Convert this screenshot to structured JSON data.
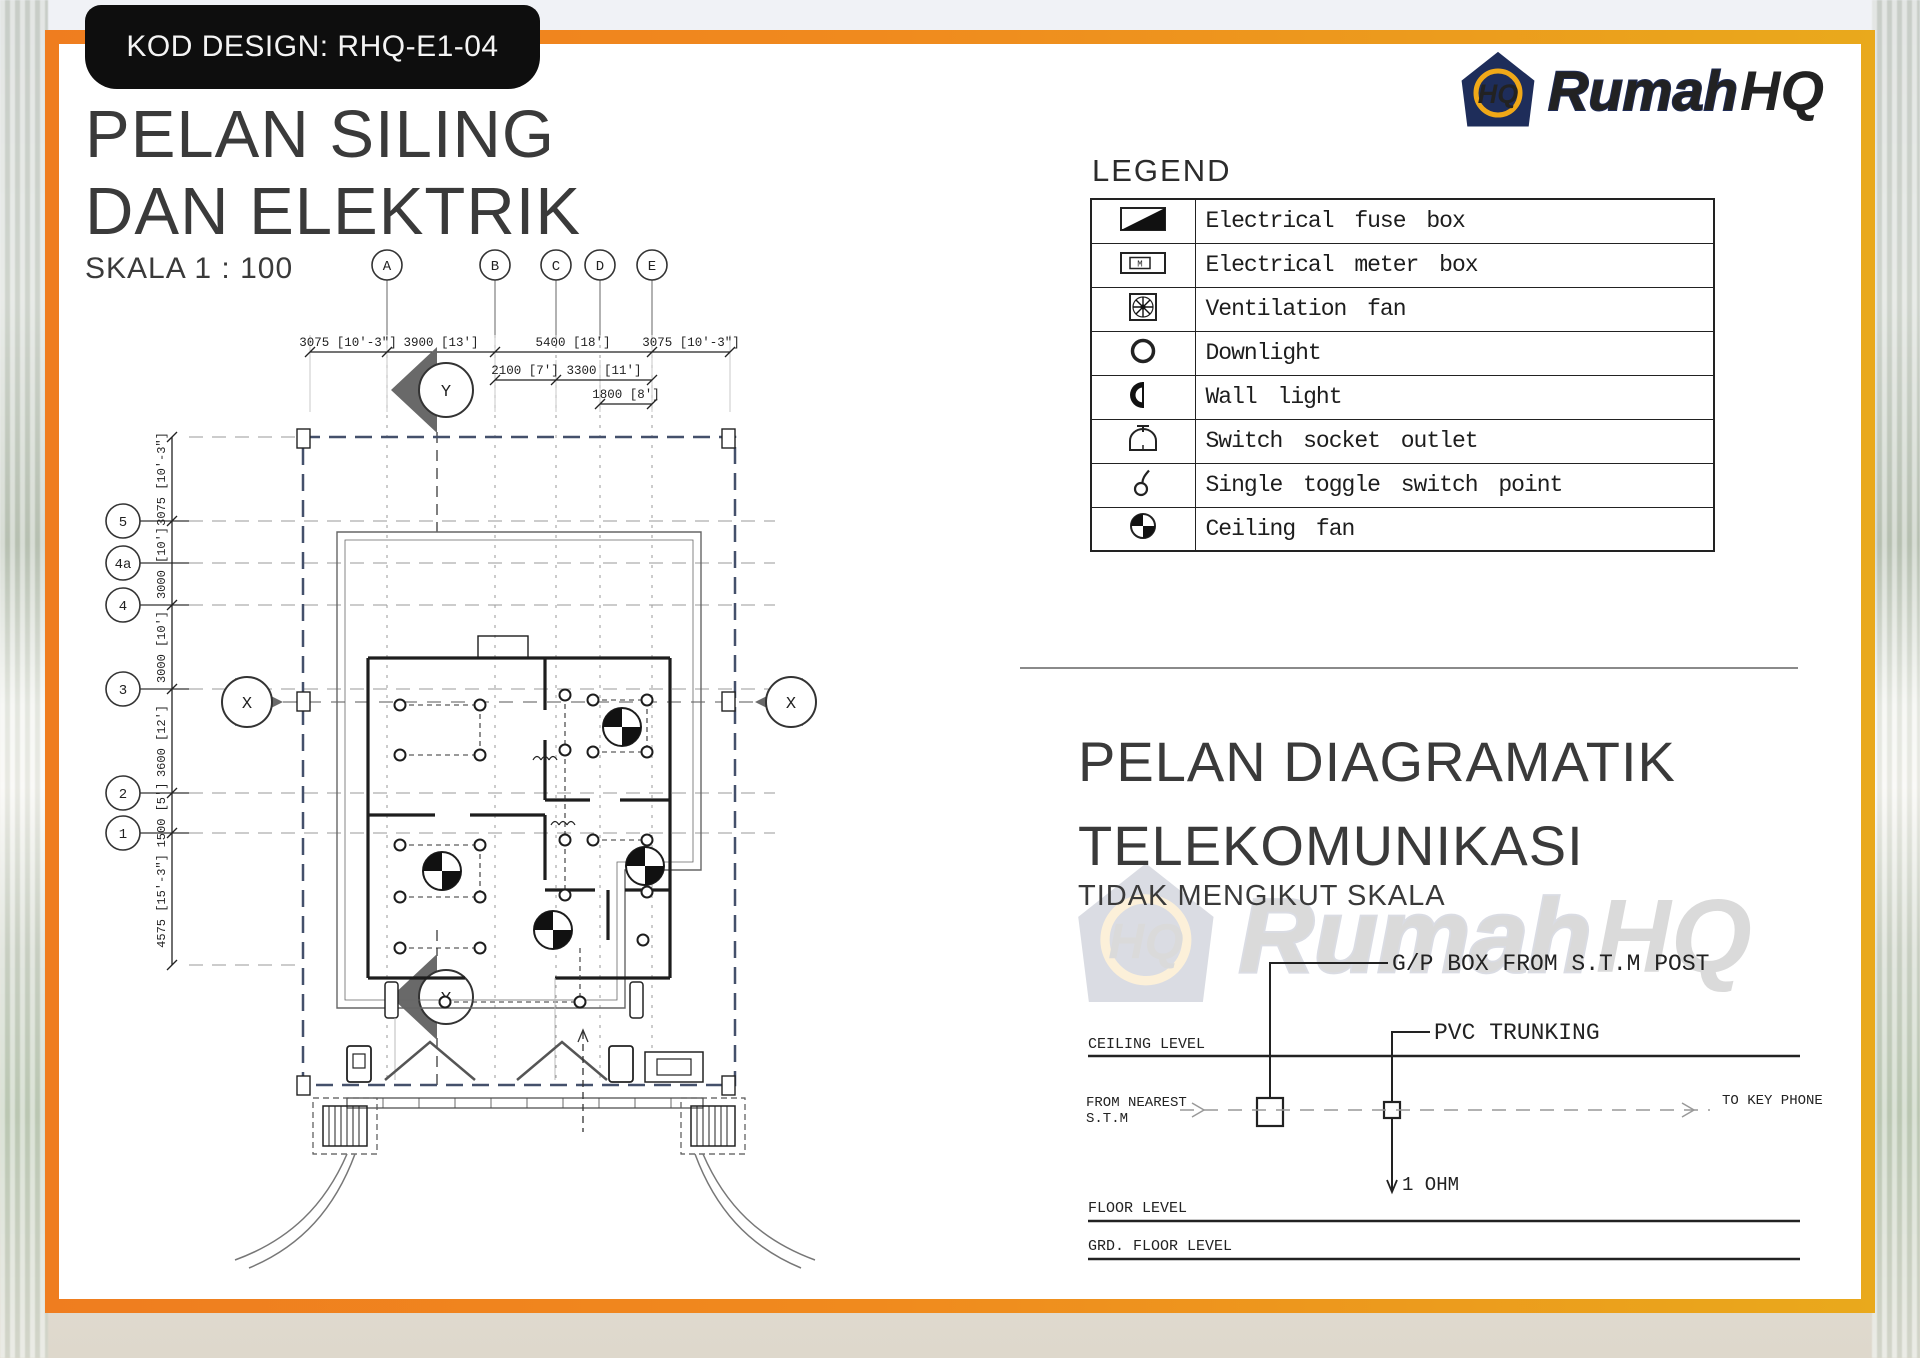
{
  "badge": {
    "label": "KOD DESIGN: RHQ-E1-04"
  },
  "logo": {
    "rumah": "Rumah",
    "hq": "HQ",
    "icon_text": "HQ"
  },
  "main_title": {
    "line1": "PELAN SILING",
    "line2": "DAN ELEKTRIK",
    "scale": "SKALA 1 : 100"
  },
  "legend": {
    "heading": "LEGEND",
    "rows": [
      {
        "icon": "electrical-fuse-box",
        "label": "Electrical fuse box"
      },
      {
        "icon": "electrical-meter-box",
        "label": "Electrical meter box"
      },
      {
        "icon": "ventilation-fan",
        "label": "Ventilation fan"
      },
      {
        "icon": "downlight",
        "label": "Downlight"
      },
      {
        "icon": "wall-light",
        "label": "Wall light"
      },
      {
        "icon": "switch-socket-outlet",
        "label": "Switch socket outlet"
      },
      {
        "icon": "single-toggle-switch",
        "label": "Single toggle switch point"
      },
      {
        "icon": "ceiling-fan",
        "label": "Ceiling fan"
      }
    ]
  },
  "plan": {
    "col_markers": [
      "A",
      "B",
      "C",
      "D",
      "E"
    ],
    "row_markers": [
      "5",
      "4a",
      "4",
      "3",
      "2",
      "1"
    ],
    "section_x": "X",
    "section_y": "Y",
    "top_dims": [
      "3075 [10'-3\"]",
      "3900 [13']",
      "5400 [18']",
      "3075 [10'-3\"]"
    ],
    "mid_dims": [
      "2100 [7']",
      "3300 [11']"
    ],
    "low_dims": [
      "1800 [8']"
    ],
    "left_dims": [
      "3075 [10'-3\"]",
      "3000 [10']",
      "3000 [10']",
      "3600 [12']",
      "1500 [5']",
      "4575 [15'-3\"]"
    ]
  },
  "telecom": {
    "title_line1": "PELAN DIAGRAMATIK",
    "title_line2": "TELEKOMUNIKASI",
    "subtitle": "TIDAK MENGIKUT SKALA",
    "gp_box": "G/P BOX FROM  S.T.M  POST",
    "pvc": "PVC TRUNKING",
    "ceiling_level": "CEILING LEVEL",
    "from_nearest_1": "FROM NEAREST",
    "from_nearest_2": "S.T.M",
    "to_key_phone": "TO KEY PHONE",
    "ohm": "1 OHM",
    "floor_level": "FLOOR LEVEL",
    "grd_floor_level": "GRD. FLOOR LEVEL"
  },
  "colors": {
    "accent_orange": "#f0801f",
    "accent_gold": "#e9a91c",
    "brand_navy": "#1e2d5a",
    "brand_gold": "#f2a71b",
    "boundary_blue": "#44506b",
    "ink": "#2f2f2f"
  }
}
